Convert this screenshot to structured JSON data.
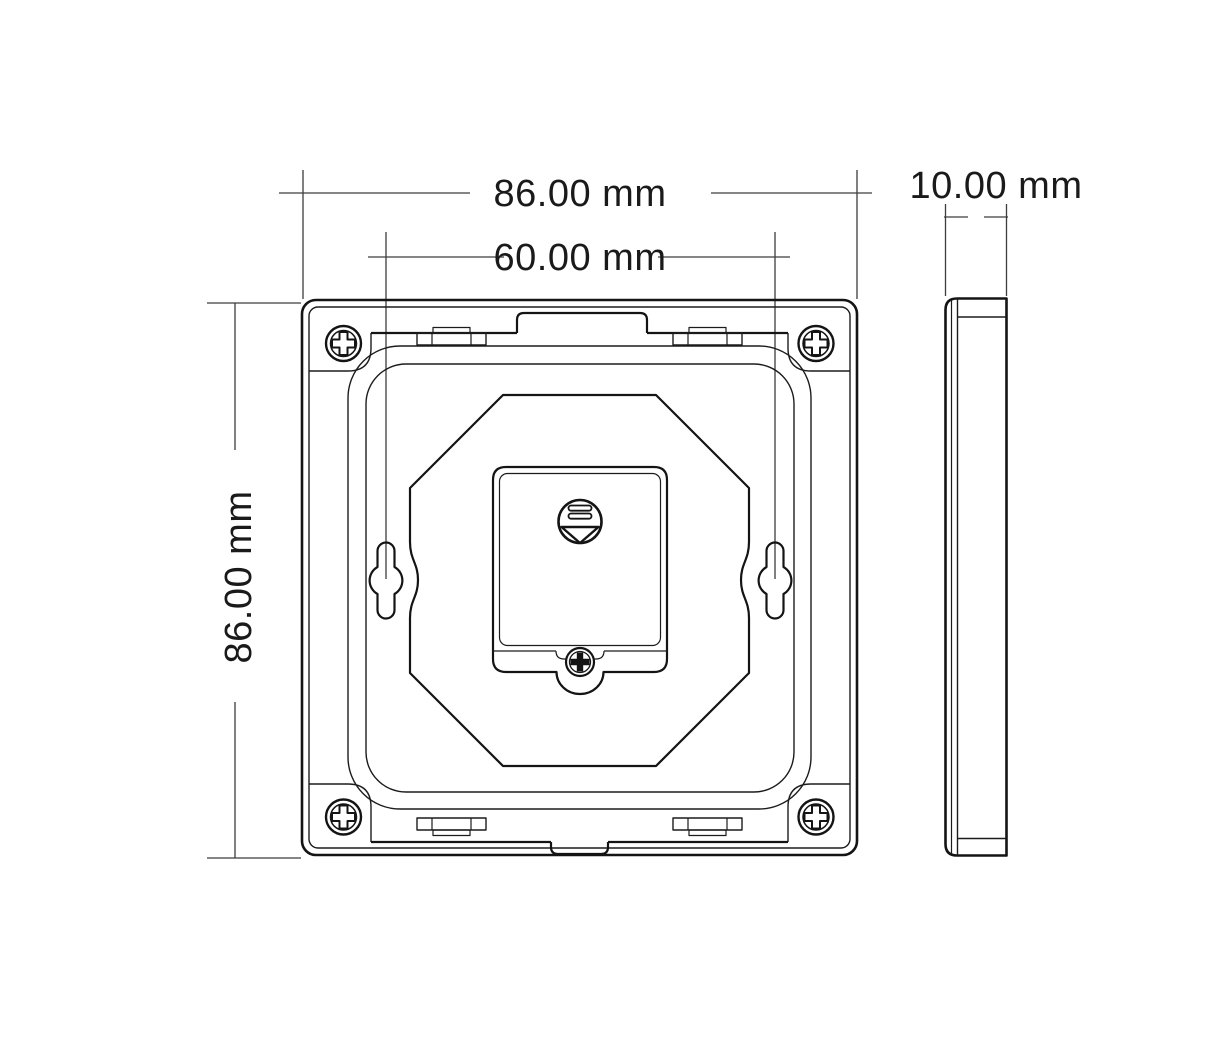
{
  "drawing": {
    "type": "mechanical-dimension-drawing",
    "views": {
      "front_view": "back side of square wall panel",
      "side_view": "panel profile"
    },
    "dimensions": {
      "top_width": "86.00 mm",
      "hole_spacing": "60.00 mm",
      "left_height": "86.00 mm",
      "side_depth": "10.00 mm"
    },
    "icons": {
      "release_button": "grip-bars-with-down-arrow-icon",
      "corner_fasteners": "phillips-screw-icon",
      "cover_fastener": "phillips-screw-icon"
    },
    "colors": {
      "line": "#141414",
      "dimension_line": "#3c3c3c",
      "text": "#1a1a1a",
      "background": "#ffffff"
    }
  }
}
